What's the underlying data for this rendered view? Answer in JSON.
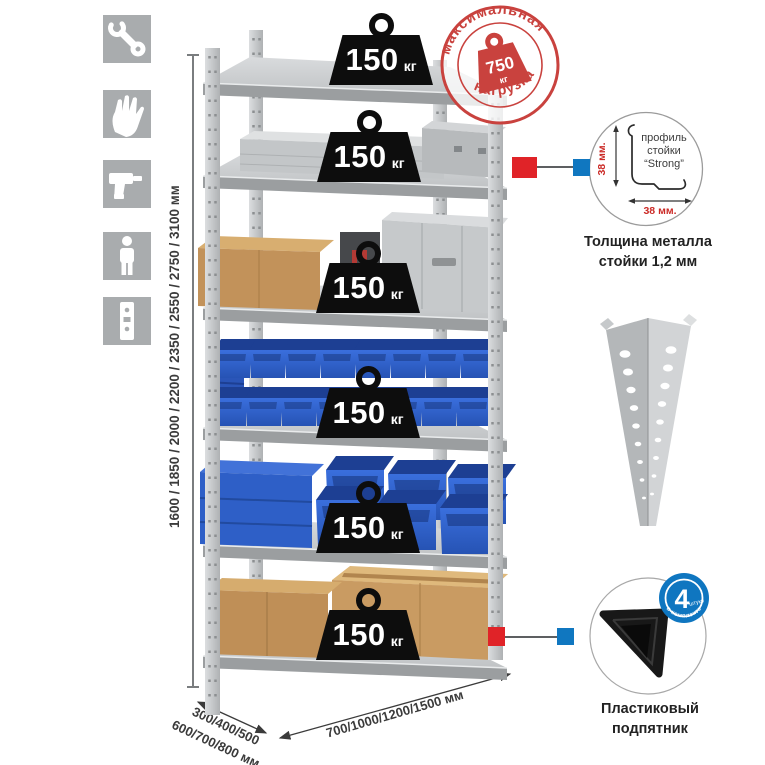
{
  "sidebar": {
    "icons": [
      {
        "name": "wrench"
      },
      {
        "name": "gloves"
      },
      {
        "name": "drill"
      },
      {
        "name": "person"
      },
      {
        "name": "rack-post"
      }
    ]
  },
  "rack": {
    "shelf_load_value": "150",
    "shelf_load_unit": "кг"
  },
  "max_load": {
    "arc_top": "максимальная",
    "arc_bottom": "нагрузка",
    "value": "750",
    "unit": "кг"
  },
  "dimensions": {
    "height": "1600 / 1850 / 2000 / 2200 / 2350 / 2550 / 2750 / 3100 мм",
    "depth_line1": "300/400/500",
    "depth_line2": "600/700/800 мм",
    "width": "700/1000/1200/1500 мм"
  },
  "profile_detail": {
    "label_line1": "профиль",
    "label_line2": "стойки",
    "label_line3": "“Strong”",
    "dim_vertical": "38 мм.",
    "dim_horizontal": "38 мм.",
    "caption_line1": "Толщина металла",
    "caption_line2": "стойки 1,2 мм"
  },
  "foot_detail": {
    "count": "4",
    "count_unit": "штуки",
    "ring_text": "в комплекте",
    "caption_line1": "Пластиковый",
    "caption_line2": "подпятник"
  },
  "colors": {
    "accent_red": "#c9423e",
    "connector_red": "#e02328",
    "connector_blue": "#1077c0",
    "bin_blue": "#2e62cc",
    "icon_bg": "#a9acae"
  }
}
